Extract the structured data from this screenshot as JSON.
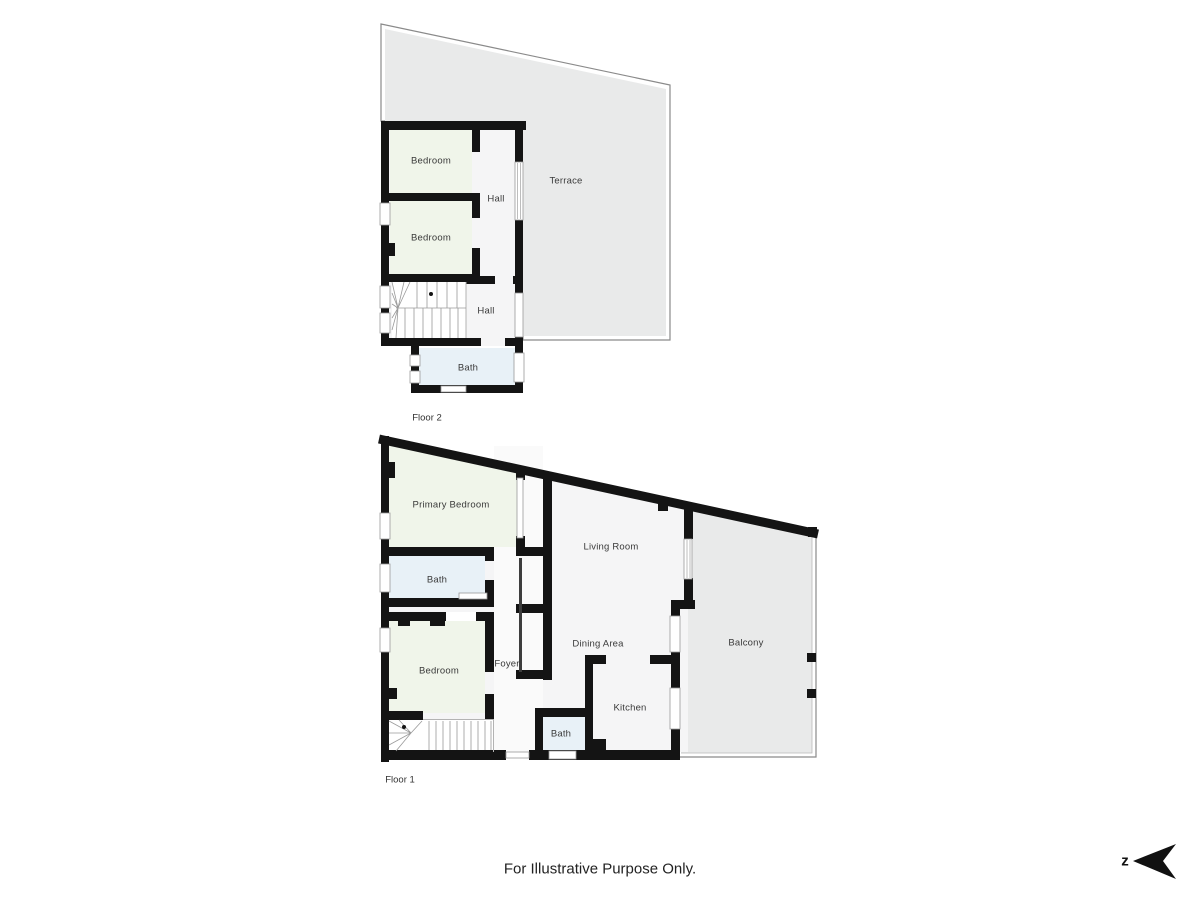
{
  "floor2": {
    "title": "Floor 2",
    "rooms": {
      "bedroom1": "Bedroom",
      "bedroom2": "Bedroom",
      "hall_upper": "Hall",
      "hall_lower": "Hall",
      "bath": "Bath",
      "terrace": "Terrace"
    }
  },
  "floor1": {
    "title": "Floor 1",
    "rooms": {
      "primary_bedroom": "Primary Bedroom",
      "bath_upper": "Bath",
      "bedroom": "Bedroom",
      "foyer": "Foyer",
      "living_room": "Living Room",
      "dining_area": "Dining Area",
      "kitchen": "Kitchen",
      "bath_lower": "Bath",
      "balcony": "Balcony"
    }
  },
  "footer": {
    "disclaimer": "For Illustrative Purpose Only."
  },
  "compass": {
    "label": "z"
  },
  "colors": {
    "wall": "#141414",
    "bedroom_fill": "#f0f5ea",
    "bath_fill": "#e8f1f7",
    "common_fill": "#f5f5f6",
    "foyer_fill": "#fafafa",
    "outdoor_fill": "#e9eaea",
    "background": "#ffffff"
  }
}
